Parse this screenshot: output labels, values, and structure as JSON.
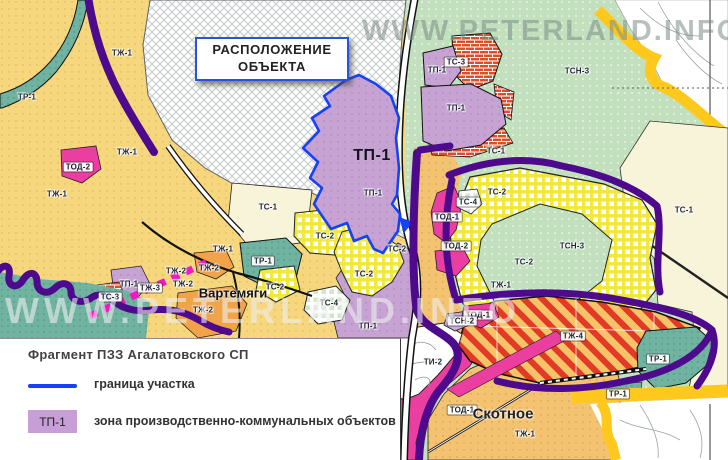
{
  "watermarks": {
    "top": "WWW.PETERLAND.INFO",
    "middle": "WWW.PETERLAND.INFO"
  },
  "callout": {
    "line1": "РАСПОЛОЖЕНИЕ",
    "line2": "ОБЪЕКТА"
  },
  "site": {
    "code": "ТП-1"
  },
  "places": {
    "vartemyagi": "Вартемяги",
    "skotnoye": "Скотное"
  },
  "legend": {
    "title": "Фрагмент ПЗЗ Агалатовского СП",
    "boundary_label": "граница участка",
    "zone_code": "ТП-1",
    "zone_label": "зона производственно-коммунальных объектов",
    "boundary_color": "#1741f5",
    "zone_color": "#c79fd6"
  },
  "labels": [
    "ТР-1",
    "ТЖ-1",
    "ТЖ-1",
    "ТОД-2",
    "ТЖ-1",
    "ТС-1",
    "ТЖ-1",
    "ТР-1",
    "ТЖ-2",
    "ТЖ-2",
    "ТЖ-2",
    "ТП-1",
    "ТЖ-3",
    "ТС-2",
    "ТС-3",
    "ТЖ-2",
    "ТС-2",
    "ТС-2",
    "ТС-2",
    "ТС-4",
    "ТП-1",
    "ТП-1",
    "ТС-3",
    "ТП-1",
    "ТСН-3",
    "ТС-1",
    "ТС-2",
    "ТС-4",
    "ТОД-1",
    "ТОД-2",
    "ТСН-3",
    "ТС-2",
    "ТС-1",
    "ТЖ-1",
    "ТОД-1",
    "ТСН-2",
    "ТЖ-4",
    "ТИ-2",
    "ТР-1",
    "ТР-1",
    "ТОД-1",
    "ТЖ-1",
    "ТП-1"
  ]
}
